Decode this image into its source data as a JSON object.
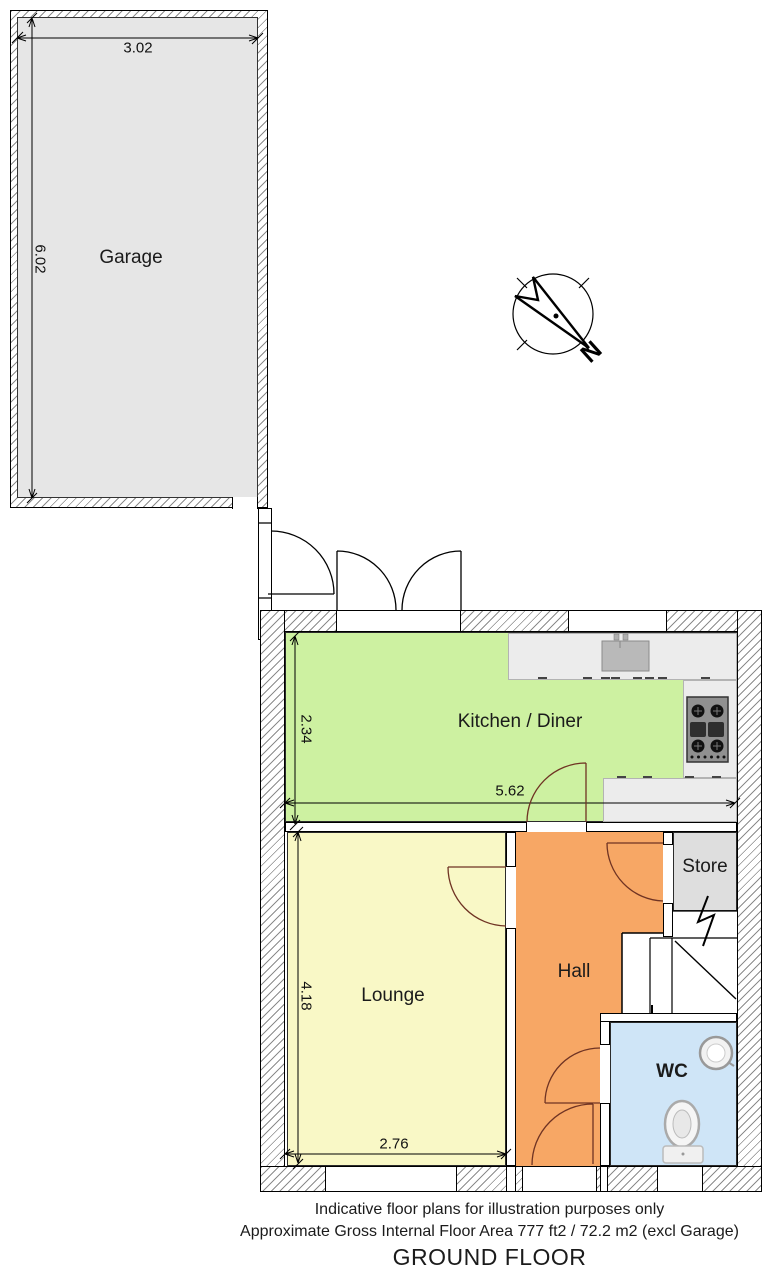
{
  "rooms": {
    "garage": {
      "label": "Garage",
      "color": "#e6e6e6",
      "width_m": "3.02",
      "depth_m": "6.02"
    },
    "kitchen_diner": {
      "label": "Kitchen / Diner",
      "color": "#cdf1a1",
      "depth_m": "2.34",
      "width_m": "5.62"
    },
    "lounge": {
      "label": "Lounge",
      "color": "#f9f8c6",
      "depth_m": "4.18",
      "width_m": "2.76"
    },
    "hall": {
      "label": "Hall",
      "color": "#f7a765"
    },
    "store": {
      "label": "Store",
      "color": "#dedede"
    },
    "wc": {
      "label": "WC",
      "color": "#cfe5f7"
    }
  },
  "compass": {
    "north_label": "N"
  },
  "footer": {
    "disclaimer": "Indicative floor plans for illustration purposes only",
    "area_note": "Approximate Gross Internal Floor Area 777 ft2 / 72.2 m2 (excl Garage)",
    "floor_title": "GROUND FLOOR"
  }
}
